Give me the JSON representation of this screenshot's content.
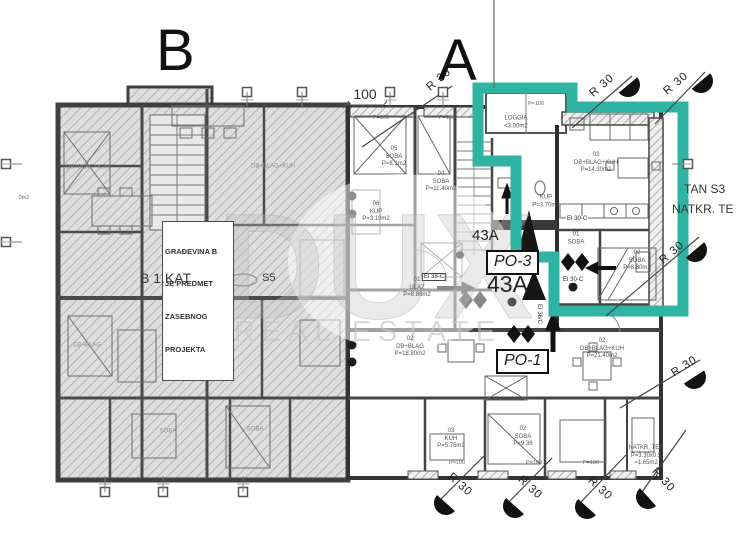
{
  "letters": {
    "b": "B",
    "a": "A"
  },
  "colors": {
    "highlight": "#2fb4a4",
    "wall_dark": "#333333",
    "hatch": "#b4b4b4"
  },
  "watermark": {
    "line1": "DUX",
    "line2": "REAL ESTATE"
  },
  "note_box": {
    "l1": "GRAĐEVINA B",
    "l2": "JE PREDMET",
    "l3": "ZASEBNOG",
    "l4": "PROJEKTA"
  },
  "floor_label": {
    "prefix": "B 1.KAT",
    "suffix": "S5"
  },
  "plot_labels": {
    "small_43a": "43A",
    "large_43a": "43A",
    "po3": "PO-3",
    "po1": "PO-1"
  },
  "stan_label": {
    "line1": "TAN S3",
    "line2": "NATKR. TE"
  },
  "dim_top": "100",
  "r30_label": "R 30",
  "rooms": [
    {
      "lines": [
        "05",
        "SOBA",
        "P=8.1m2"
      ],
      "cx": 394,
      "cy": 157
    },
    {
      "lines": [
        "04",
        "SOBA",
        "P=11.40m2"
      ],
      "cx": 441,
      "cy": 182
    },
    {
      "lines": [
        "06",
        "KUP",
        "P=3.10m2"
      ],
      "cx": 376,
      "cy": 212
    },
    {
      "lines": [
        "01",
        "ULAZ",
        "P=8.86m2"
      ],
      "cx": 417,
      "cy": 288
    },
    {
      "lines": [
        "02",
        "DB+BLAG",
        "P=18.80m2"
      ],
      "cx": 410,
      "cy": 347
    },
    {
      "lines": [
        "03",
        "DB+BLAG+KUH",
        "P=14.30m2"
      ],
      "cx": 596,
      "cy": 163
    },
    {
      "lines": [
        "KUP",
        "P=3.70m2"
      ],
      "cx": 546,
      "cy": 202
    },
    {
      "lines": [
        "01",
        "SOBA"
      ],
      "cx": 576,
      "cy": 239
    },
    {
      "lines": [
        "02",
        "SOBA",
        "P=8.80m2"
      ],
      "cx": 637,
      "cy": 261
    },
    {
      "lines": [
        "LOGGIA",
        "<3.00m2"
      ],
      "cx": 516,
      "cy": 123
    },
    {
      "lines": [
        "02",
        "DB+BLAG+KUH",
        "P=21.40m2"
      ],
      "cx": 602,
      "cy": 349
    },
    {
      "lines": [
        "03",
        "KUH",
        "P=5.75m2"
      ],
      "cx": 451,
      "cy": 439
    },
    {
      "lines": [
        "02",
        "SOBA",
        "P=9.36"
      ],
      "cx": 523,
      "cy": 437
    },
    {
      "lines": [
        "NATKR. TER",
        "P=3.30x0.5",
        "=1.65m2"
      ],
      "cx": 646,
      "cy": 456
    },
    {
      "lines": [
        "DB+BLAG+KUH"
      ],
      "cx": 273,
      "cy": 167,
      "faint": true
    },
    {
      "lines": [
        "DB+BLAG+KUH"
      ],
      "cx": 88,
      "cy": 168,
      "faint": true
    },
    {
      "lines": [
        "DB+BLAG"
      ],
      "cx": 87,
      "cy": 346,
      "faint": true
    },
    {
      "lines": [
        "SOBA"
      ],
      "cx": 168,
      "cy": 432,
      "faint": true
    },
    {
      "lines": [
        "SOBA"
      ],
      "cx": 255,
      "cy": 430,
      "faint": true
    }
  ],
  "dims": [
    {
      "t": "P=100",
      "x": 381,
      "y": 118
    },
    {
      "t": "P=100",
      "x": 447,
      "y": 118
    },
    {
      "t": "P=100",
      "x": 536,
      "y": 104
    },
    {
      "t": "P=100",
      "x": 457,
      "y": 463
    },
    {
      "t": "P=100",
      "x": 534,
      "y": 463
    },
    {
      "t": "P=100",
      "x": 591,
      "y": 463
    },
    {
      "t": "0m2",
      "x": 24,
      "y": 198
    }
  ],
  "fire_labels": [
    {
      "t": "EI 38-C",
      "x": 434,
      "y": 277,
      "boxed": true
    },
    {
      "t": "EI 30-C",
      "x": 577,
      "y": 219
    },
    {
      "t": "EI 30-C",
      "x": 573,
      "y": 280
    },
    {
      "t": "EI 36/C",
      "x": 539,
      "y": 314,
      "rot": 90
    }
  ],
  "r30_markers": [
    {
      "tx": 441,
      "ty": 82,
      "rot": -40,
      "x1": 362,
      "y1": 147,
      "x2": 452,
      "y2": 86
    },
    {
      "tx": 604,
      "ty": 88,
      "rot": -40,
      "x1": 572,
      "y1": 128,
      "x2": 632,
      "y2": 76,
      "c": [
        628,
        85
      ]
    },
    {
      "tx": 678,
      "ty": 86,
      "rot": -40,
      "x1": 655,
      "y1": 124,
      "x2": 705,
      "y2": 72,
      "c": [
        701,
        81
      ]
    },
    {
      "tx": 674,
      "ty": 255,
      "rot": -40,
      "x1": 606,
      "y1": 316,
      "x2": 699,
      "y2": 237,
      "c": [
        695,
        250
      ]
    },
    {
      "tx": 686,
      "ty": 369,
      "rot": -33,
      "x1": 620,
      "y1": 408,
      "x2": 700,
      "y2": 360,
      "c": [
        694,
        377
      ]
    },
    {
      "tx": 458,
      "ty": 487,
      "rot": 42,
      "x1": 484,
      "y1": 456,
      "x2": 440,
      "y2": 500,
      "c": [
        446,
        503
      ]
    },
    {
      "tx": 528,
      "ty": 490,
      "rot": 42,
      "x1": 552,
      "y1": 458,
      "x2": 509,
      "y2": 502,
      "c": [
        515,
        506
      ]
    },
    {
      "tx": 598,
      "ty": 491,
      "rot": 42,
      "x1": 626,
      "y1": 455,
      "x2": 581,
      "y2": 502,
      "c": [
        587,
        507
      ]
    },
    {
      "tx": 661,
      "ty": 482,
      "rot": 48,
      "x1": 686,
      "y1": 430,
      "x2": 642,
      "y2": 492,
      "c": [
        648,
        497
      ]
    }
  ],
  "ref_squares": [
    {
      "x": 247,
      "y": 92,
      "dir": "down"
    },
    {
      "x": 302,
      "y": 92,
      "dir": "down"
    },
    {
      "x": 390,
      "y": 92,
      "dir": "down"
    },
    {
      "x": 443,
      "y": 92,
      "dir": "down"
    },
    {
      "x": 105,
      "y": 492,
      "dir": "up"
    },
    {
      "x": 163,
      "y": 492,
      "dir": "up"
    },
    {
      "x": 243,
      "y": 492,
      "dir": "up"
    },
    {
      "x": 6,
      "y": 164,
      "dir": "right"
    },
    {
      "x": 6,
      "y": 242,
      "dir": "right"
    },
    {
      "x": 688,
      "y": 164,
      "dir": "left"
    }
  ]
}
